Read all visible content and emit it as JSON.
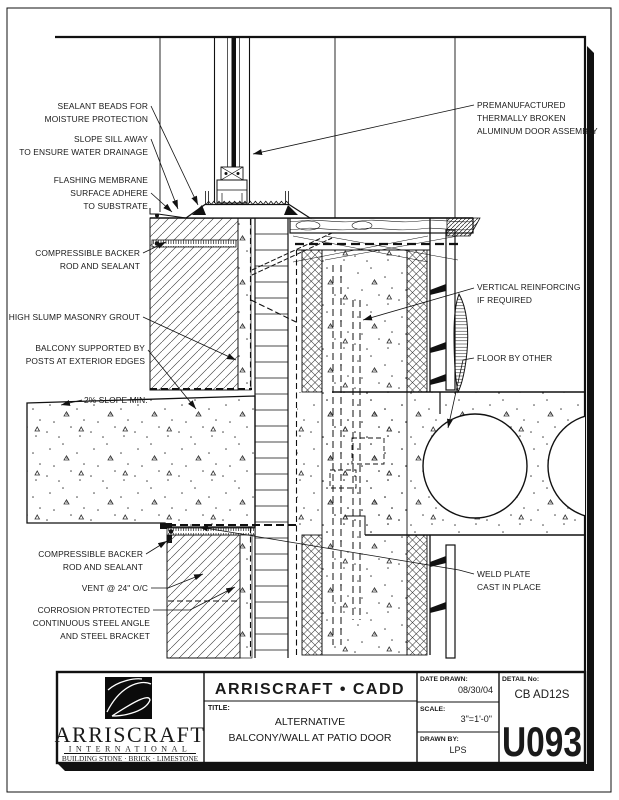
{
  "colors": {
    "ink": "#111111",
    "paper": "#ffffff"
  },
  "annotations": {
    "sealant": {
      "lines": [
        "SEALANT BEADS FOR",
        "MOISTURE PROTECTION"
      ]
    },
    "slope_sill": {
      "lines": [
        "SLOPE SILL AWAY",
        "TO ENSURE WATER DRAINAGE"
      ]
    },
    "flashing": {
      "lines": [
        "FLASHING MEMBRANE",
        "SURFACE ADHERE",
        "TO SUBSTRATE"
      ]
    },
    "backer_top": {
      "lines": [
        "COMPRESSIBLE BACKER",
        "ROD AND SEALANT"
      ]
    },
    "grout": {
      "lines": [
        "HIGH SLUMP MASONRY GROUT"
      ]
    },
    "balcony": {
      "lines": [
        "BALCONY SUPPORTED BY",
        "POSTS AT EXTERIOR EDGES"
      ]
    },
    "slope_min": {
      "lines": [
        "2% SLOPE MIN."
      ]
    },
    "backer_bottom": {
      "lines": [
        "COMPRESSIBLE BACKER",
        "ROD AND SEALANT"
      ]
    },
    "vent": {
      "lines": [
        "VENT @ 24\" O/C"
      ]
    },
    "corrosion": {
      "lines": [
        "CORROSION PRTOTECTED",
        "CONTINUOUS STEEL ANGLE",
        "AND STEEL BRACKET"
      ]
    },
    "door": {
      "lines": [
        "PREMANUFACTURED",
        "THERMALLY BROKEN",
        "ALUMINUM DOOR ASSEMBLY"
      ]
    },
    "reinforcing": {
      "lines": [
        "VERTICAL REINFORCING",
        "IF REQUIRED"
      ]
    },
    "floor": {
      "lines": [
        "FLOOR BY OTHER"
      ]
    },
    "weld": {
      "lines": [
        "WELD PLATE",
        "CAST IN PLACE"
      ]
    }
  },
  "titleblock": {
    "header": "ARRISCRAFT • CADD",
    "title_label": "TITLE:",
    "title_lines": [
      "ALTERNATIVE",
      "BALCONY/WALL AT PATIO DOOR"
    ],
    "date_label": "DATE DRAWN:",
    "date_value": "08/30/04",
    "scale_label": "SCALE:",
    "scale_value": "3\"=1'-0\"",
    "drawn_label": "DRAWN BY:",
    "drawn_value": "LPS",
    "detail_label": "DETAIL No:",
    "detail_code": "CB AD12S",
    "detail_number": "U093",
    "company": {
      "name": "ARRISCRAFT",
      "subtitle": "INTERNATIONAL",
      "tagline": "BUILDING STONE · BRICK · LIMESTONE"
    }
  }
}
